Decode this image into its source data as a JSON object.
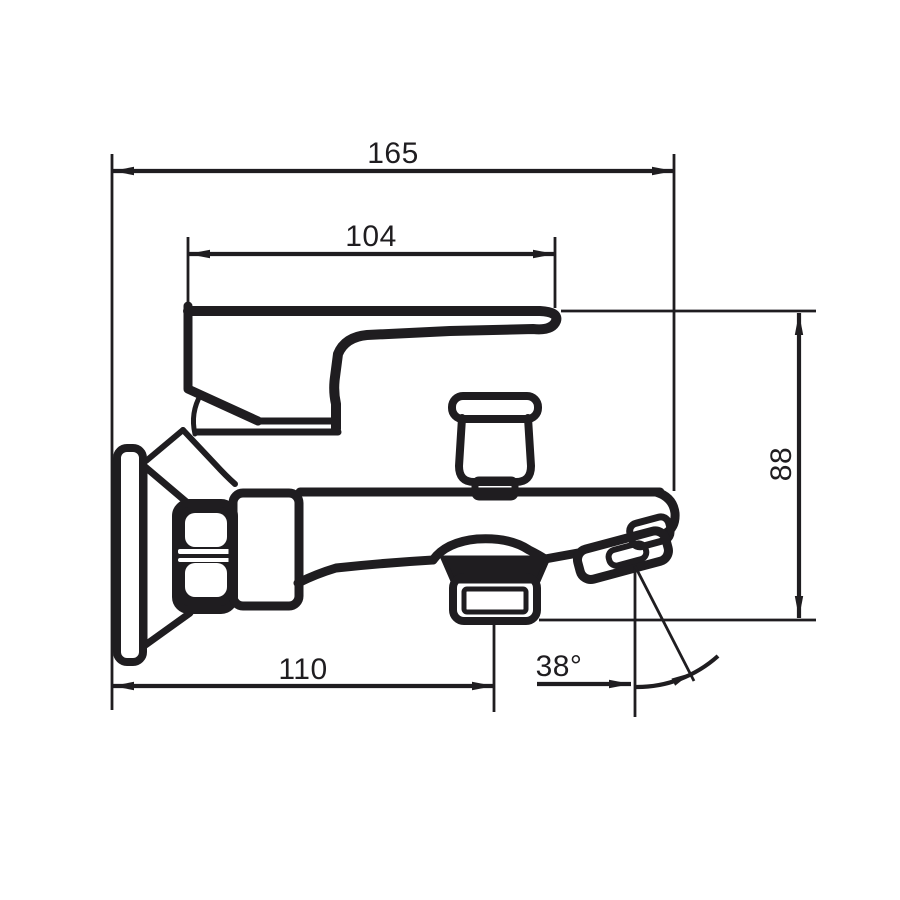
{
  "meta": {
    "type": "technical-dimension-drawing",
    "subject": "wall-mounted bath shower mixer tap, side elevation"
  },
  "colors": {
    "background": "#ffffff",
    "line": "#1f1d20"
  },
  "dimensions": {
    "total_depth": {
      "label": "165",
      "orientation": "horizontal-top"
    },
    "body_top_length": {
      "label": "104",
      "orientation": "horizontal-upper"
    },
    "overall_height": {
      "label": "88",
      "orientation": "vertical-right"
    },
    "spout_reach": {
      "label": "110",
      "orientation": "horizontal-bottom"
    },
    "handshower_angle": {
      "label": "38°",
      "orientation": "angular"
    }
  }
}
